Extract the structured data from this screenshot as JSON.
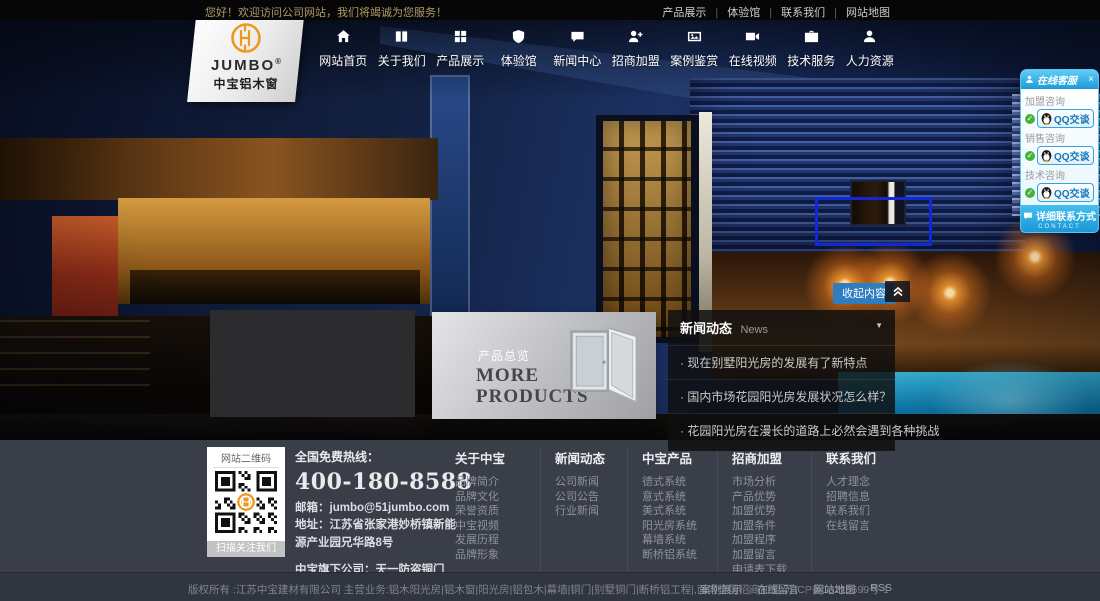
{
  "topbar": {
    "welcome": "您好！欢迎访问公司网站，我们将竭诚为您服务！",
    "links": [
      "产品展示",
      "体验馆",
      "联系我们",
      "网站地图"
    ]
  },
  "logo": {
    "brand": "JUMBO",
    "reg": "®",
    "subtitle": "中宝铝木窗"
  },
  "nav": {
    "items": [
      {
        "name": "home",
        "label": "网站首页",
        "icon": "home-icon"
      },
      {
        "name": "about",
        "label": "关于我们",
        "icon": "book-icon"
      },
      {
        "name": "products",
        "label": "产品展示",
        "icon": "grid-icon"
      },
      {
        "name": "experience",
        "label": "体验馆",
        "icon": "shield-icon"
      },
      {
        "name": "news",
        "label": "新闻中心",
        "icon": "chat-icon"
      },
      {
        "name": "franchise",
        "label": "招商加盟",
        "icon": "user-plus-icon"
      },
      {
        "name": "cases",
        "label": "案例鉴赏",
        "icon": "gallery-icon"
      },
      {
        "name": "video",
        "label": "在线视频",
        "icon": "video-icon"
      },
      {
        "name": "tech",
        "label": "技术服务",
        "icon": "briefcase-icon"
      },
      {
        "name": "hr",
        "label": "人力资源",
        "icon": "user-icon"
      }
    ]
  },
  "service_panel": {
    "title": "在线客服",
    "close_icon": "×",
    "check_icon": "✓",
    "groups": [
      {
        "label": "加盟咨询",
        "qq_label": "QQ交谈"
      },
      {
        "label": "销售咨询",
        "qq_label": "QQ交谈"
      },
      {
        "label": "技术咨询",
        "qq_label": "QQ交谈"
      }
    ],
    "footer_label": "详细联系方式",
    "footer_sub": "CONTACT"
  },
  "hero": {
    "collapse_button": "收起内容"
  },
  "products_card": {
    "title": "产品总览",
    "subtitle": "MORE PRODUCTS"
  },
  "news": {
    "title": "新闻动态",
    "subtitle": "News",
    "caret": "▼",
    "items": [
      "现在别墅阳光房的发展有了新特点",
      "国内市场花园阳光房发展状况怎么样？",
      "花园阳光房在漫长的道路上必然会遇到各种挑战"
    ]
  },
  "footer": {
    "qr": {
      "title": "网站二维码",
      "caption": "扫描关注我们"
    },
    "hotline_label": "全国免费热线：",
    "hotline": "400-180-8588",
    "email_label": "邮箱：",
    "email": "jumbo@51jumbo.com",
    "address_label": "地址：",
    "address": "江苏省张家港妙桥镇新能源产业园兄华路8号",
    "subsidiary": "中宝旗下公司：天一防盗铜门",
    "columns": [
      {
        "title": "关于中宝",
        "links": [
          "品牌简介",
          "品牌文化",
          "荣誉资质",
          "中宝视频",
          "发展历程",
          "品牌形象"
        ]
      },
      {
        "title": "新闻动态",
        "links": [
          "公司新闻",
          "公司公告",
          "行业新闻"
        ]
      },
      {
        "title": "中宝产品",
        "links": [
          "德式系统",
          "意式系统",
          "美式系统",
          "阳光房系统",
          "幕墙系统",
          "断桥铝系统"
        ]
      },
      {
        "title": "招商加盟",
        "links": [
          "市场分析",
          "产品优势",
          "加盟优势",
          "加盟条件",
          "加盟程序",
          "加盟留言",
          "申请表下载"
        ]
      },
      {
        "title": "联系我们",
        "links": [
          "人才理念",
          "招聘信息",
          "联系我们",
          "在线留言"
        ]
      }
    ]
  },
  "bottombar": {
    "copyright": "版权所有 :江苏中宝建材有限公司 主营业务:铝木阳光房|铝木窗|阳光房|铝包木|幕墙|铜门|别墅铜门|断桥铝工程|,面向全国招商加盟 苏ICP备10215699号-1",
    "links": [
      "案例展示",
      "在线留言",
      "网站地图",
      "RSS"
    ]
  },
  "colors": {
    "accent_orange": "#f0971e",
    "service_azure": "#2eb3ea",
    "collapse_blue": "#2d7dc0",
    "footer_bg": "#3a3e48",
    "highlight_box_blue": "#1228d8"
  }
}
